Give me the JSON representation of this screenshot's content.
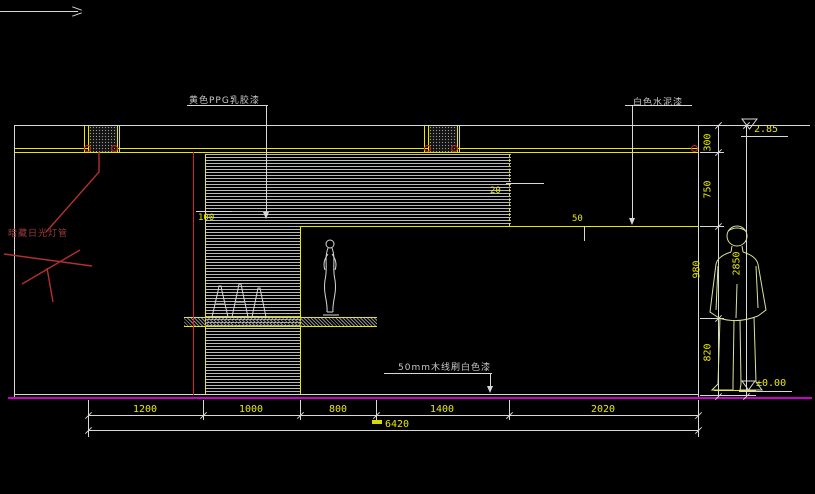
{
  "labels": {
    "paint_yellow": "黄色PPG乳胶漆",
    "paint_white": "白色水泥漆",
    "hidden_lamp": "暗藏日光灯管",
    "wood_trim": "50mm木线刷白色漆"
  },
  "dimensions": {
    "bottom_segments": [
      "1200",
      "1000",
      "800",
      "1400",
      "2020"
    ],
    "bottom_total": "6420",
    "right_segments": [
      "300",
      "750",
      "980",
      "820"
    ],
    "right_total": "2850",
    "cove_depth": "100",
    "panel_edge": "20",
    "ledge": "50"
  },
  "elevation_markers": {
    "top": "2.85",
    "bottom": "±0.00"
  },
  "colors": {
    "background": "#000000",
    "line": "#d8d8d8",
    "accent_yellow": "#e8e800",
    "floor_magenta": "#cc00cc",
    "highlight_red": "#e02020",
    "figure_green": "#d8e49c",
    "label_red": "#9b3a3a"
  }
}
